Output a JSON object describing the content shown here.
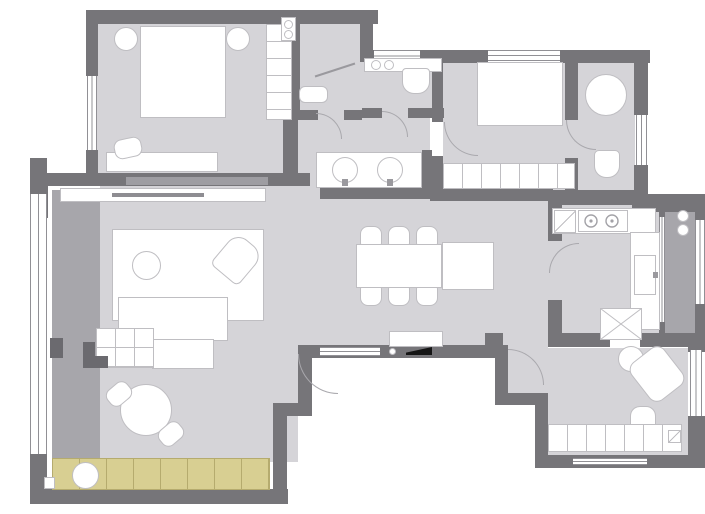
{
  "colors": {
    "wall": "#767579",
    "wall_light": "#9e9da2",
    "floor": "#d5d4d8",
    "floor_dim": "#a7a6ab",
    "deck": "#d8cf92",
    "deck_line": "#b5ab6e",
    "furniture_fill": "#ffffff",
    "furniture_line": "#bfbec2",
    "window_line": "#919095",
    "accent_black": "#151515",
    "background": "#ffffff"
  },
  "symbols": [
    "bed-icon",
    "nightstand-icon",
    "wardrobe-icon",
    "sofa-icon",
    "rug-icon",
    "coffee-table-icon",
    "armchair-icon",
    "round-table-icon",
    "chair-icon",
    "dining-table-icon",
    "sideboard-icon",
    "shower-screen-icon",
    "toilet-icon",
    "washbasin-icon",
    "vanity-sink-icon",
    "bathtub-icon",
    "stove-burner-icon",
    "kitchen-sink-icon",
    "fridge-icon",
    "cabinet-icon",
    "door-swing-icon",
    "entry-threshold-icon",
    "plant-icon",
    "water-heater-icon",
    "window-icon",
    "deck-tiles-icon"
  ]
}
